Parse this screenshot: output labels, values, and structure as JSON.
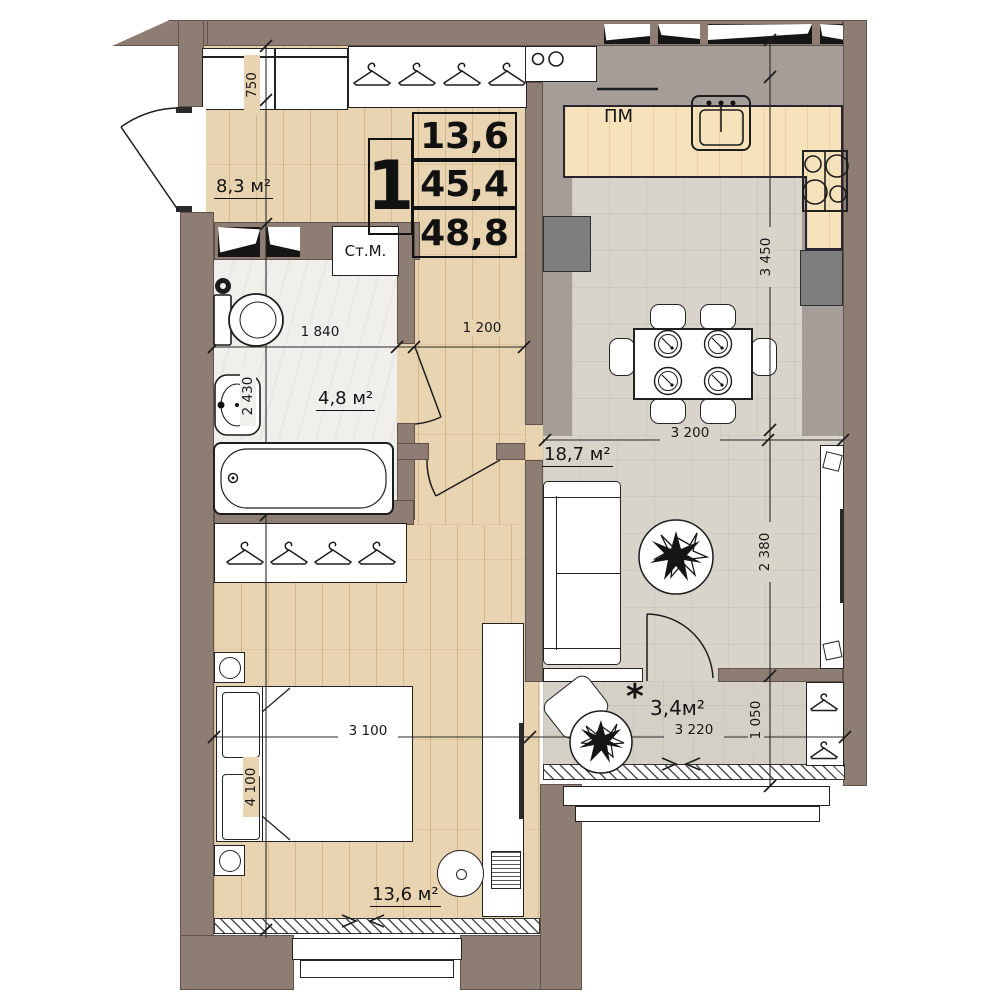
{
  "stamp": {
    "rooms_count": "1",
    "living_area": "13,6",
    "apartment_area": "45,4",
    "total_area": "48,8"
  },
  "areas": {
    "hall": "8,3 м²",
    "bathroom": "4,8 м²",
    "living": "18,7 м²",
    "bedroom": "13,6 м²",
    "balcony": "3,4м²",
    "balcony_marker": "*"
  },
  "appliances": {
    "washing_machine": "Ст.М.",
    "dishwasher": "ПМ"
  },
  "dimensions": {
    "hall_cabinet": "750",
    "bathroom_width": "1 840",
    "bathroom_height": "2 430",
    "corridor_width": "1 200",
    "kitchen_height": "3 450",
    "living_width": "3 200",
    "living_height": "2 380",
    "bedroom_width": "3 100",
    "bedroom_height": "4 100",
    "balcony_width": "3 220",
    "balcony_depth": "1 050"
  },
  "colors": {
    "wall": "#8d7d73",
    "wood_floor": "#e8d4b0",
    "tile_floor": "#d9d4ca",
    "kitchen_floor": "#a59d97",
    "counter": "#f6e3bb",
    "bathroom_floor": "#f0efec",
    "balcony_floor": "#d5d0c6",
    "cabinet_gray": "#7e7e7e",
    "line": "#1d1d1d"
  }
}
